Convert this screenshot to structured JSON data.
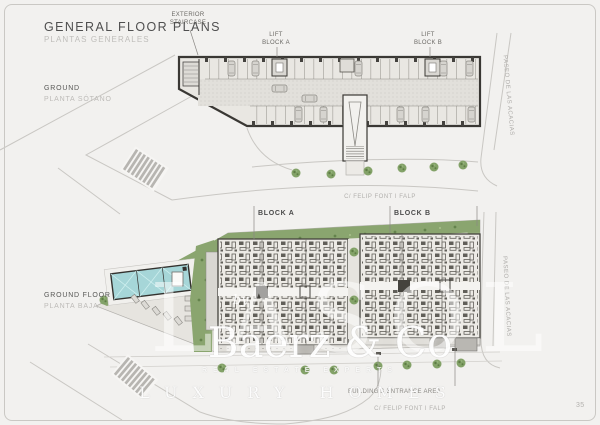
{
  "page": {
    "title": "GENERAL FLOOR PLANS",
    "subtitle": "PLANTAS GENERALES",
    "number": "35"
  },
  "basement": {
    "level": "GROUND",
    "level_es": "PLANTA SÓTANO",
    "labels": {
      "staircase": "EXTERIOR\nSTAIRCASE",
      "lift_a": "LIFT\nBLOCK A",
      "lift_b": "LIFT\nBLOCK B"
    },
    "streets": {
      "right": "PASEO DE LAS ACACIAS",
      "bottom": "C/ FELIP FONT I FALP"
    }
  },
  "ground_floor": {
    "level": "GROUND FLOOR",
    "level_es": "PLANTA BAJA",
    "labels": {
      "block_a": "BLOCK A",
      "block_b": "BLOCK B",
      "entrance": "BUILDING'S ENTRANCE AREA"
    },
    "streets": {
      "right": "PASEO DE LAS ACACIAS",
      "bottom": "C/ FELIP FONT I FALP"
    }
  },
  "watermark": {
    "ghost": "LASOL",
    "by": "by",
    "brand": "Baerz & Co",
    "strip": "REAL ESTATE EXPERTS",
    "tagline": "LUXURY HOMES"
  },
  "colors": {
    "background": "#f2f1ef",
    "wall": "#3a3834",
    "green": "#8aa56f",
    "green_dark": "#64834c",
    "pool": "#a6d6d8",
    "road_line": "#c9c7c3",
    "text_dark": "#4f4f4f",
    "text_light": "#bfbdba"
  }
}
